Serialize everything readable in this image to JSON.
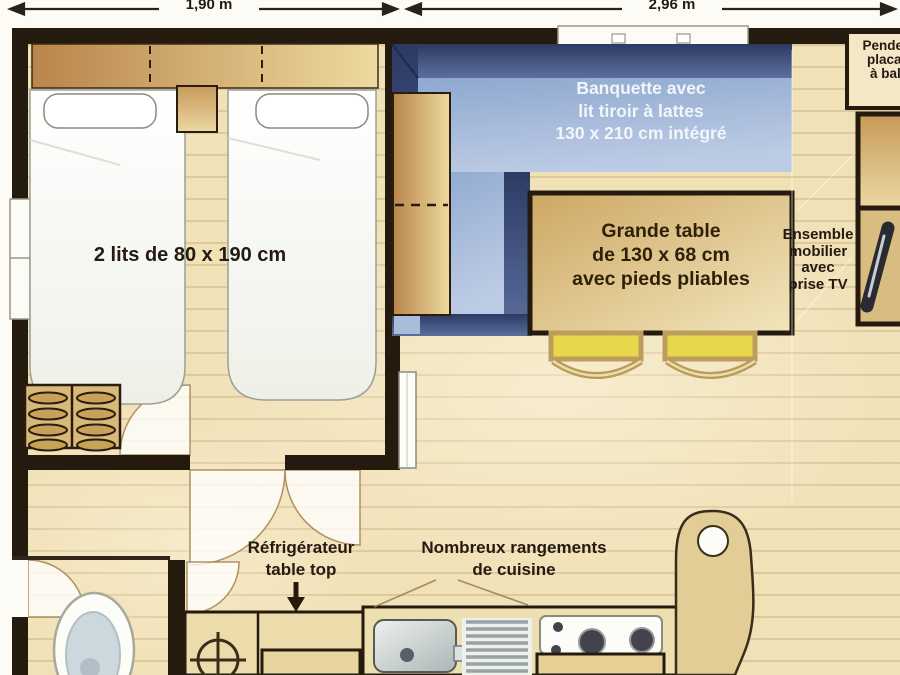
{
  "dimensions": {
    "width_left": "1,90 m",
    "width_right": "2,96 m"
  },
  "bedroom": {
    "label": "2 lits de 80 x 190 cm"
  },
  "banquette": {
    "lines": [
      "Banquette avec",
      "lit tiroir à lattes",
      "130 x 210 cm intégré"
    ]
  },
  "table": {
    "lines": [
      "Grande table",
      "de 130 x 68 cm",
      "avec pieds pliables"
    ]
  },
  "tv_corner": {
    "lines": [
      "Ensemble",
      "mobilier",
      "avec",
      "prise TV"
    ]
  },
  "wardrobe": {
    "lines": [
      "Penderie",
      "placard",
      "à balai"
    ]
  },
  "fridge": {
    "lines": [
      "Réfrigérateur",
      "table top"
    ]
  },
  "kitchen": {
    "lines": [
      "Nombreux rangements",
      "de cuisine"
    ]
  },
  "colors": {
    "wall": "#241a0e",
    "floor": "#f1e1b7",
    "wood_dark": "#b9854a",
    "wood_light": "#eeda9f",
    "banquette_back": "#2c3a63",
    "banquette_seat": "#a9bfdd",
    "chair": "#e8d74b",
    "label_text": "#241a10",
    "banquette_text": "#f2f5fa",
    "label_box": "#f3e7c6"
  }
}
